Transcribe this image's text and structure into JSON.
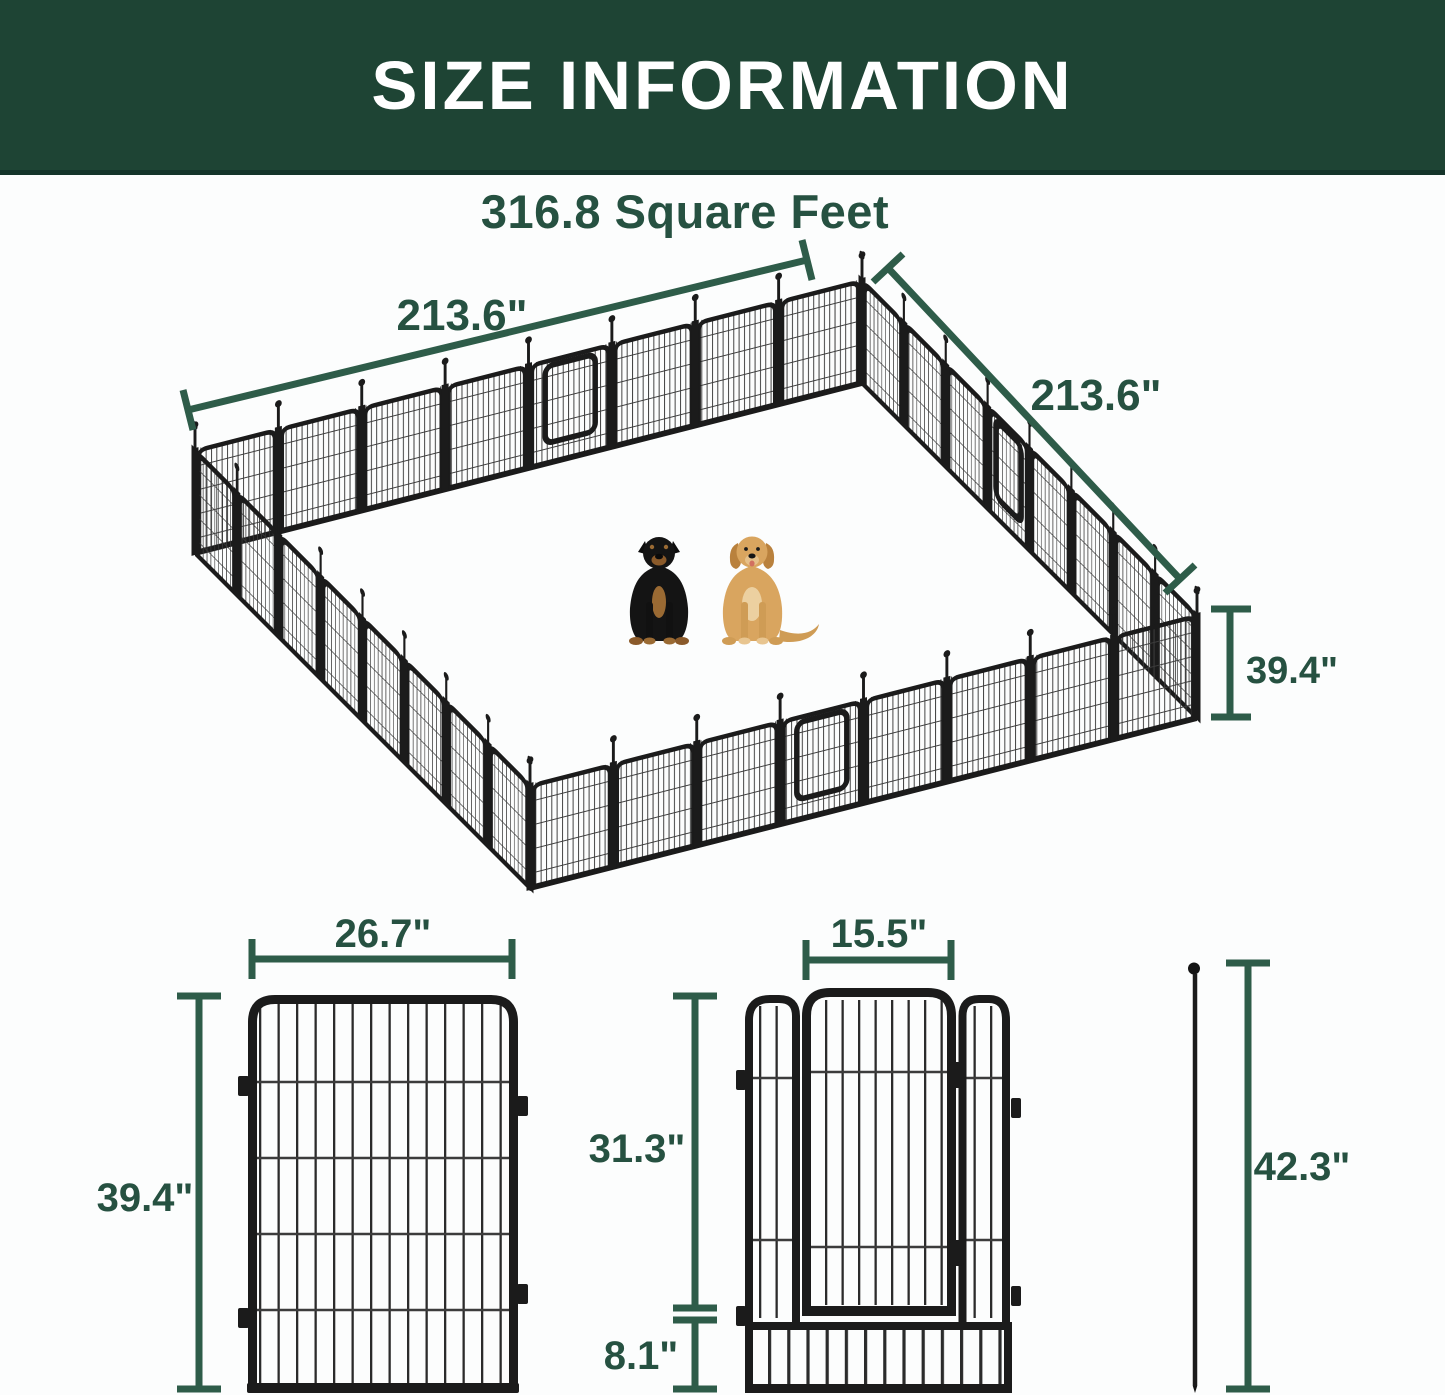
{
  "header": {
    "title": "SIZE INFORMATION"
  },
  "pen": {
    "area_label": "316.8 Square Feet",
    "width_left_label": "213.6\"",
    "width_right_label": "213.6\"",
    "height_label": "39.4\""
  },
  "panel": {
    "width_label": "26.7\"",
    "height_label": "39.4\""
  },
  "gate": {
    "door_width_label": "15.5\"",
    "door_height_label": "31.3\"",
    "bottom_height_label": "8.1\""
  },
  "stake": {
    "height_label": "42.3\""
  },
  "animals": [
    {
      "name": "rottweiler"
    },
    {
      "name": "golden-retriever"
    }
  ],
  "colors": {
    "header_bg": "#1e4434",
    "header_border": "#14342a",
    "header_text": "#ffffff",
    "dimension_line": "#2e5c49",
    "dimension_text": "#265141",
    "fence_frame": "#1b1b1b",
    "fence_wire": "#3c3c3c",
    "background": "#fcfdfd"
  }
}
